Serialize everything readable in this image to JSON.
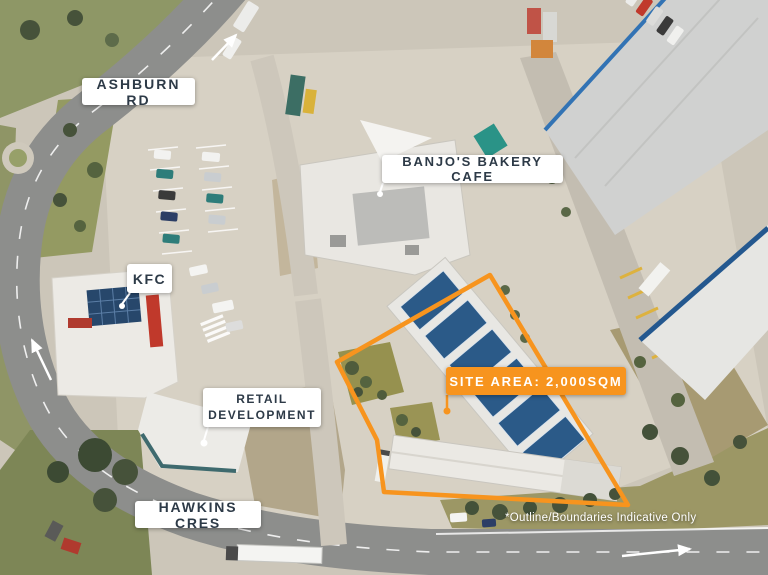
{
  "colors": {
    "accent_orange": "#F7941E",
    "label_background": "#FFFFFF",
    "label_text": "#2D3A47",
    "disclaimer_text": "#FFFFFF"
  },
  "labels": {
    "ashburn_rd": "ASHBURN RD",
    "banjos_bakery_cafe": "BANJO'S BAKERY CAFE",
    "kfc": "KFC",
    "retail_development": "RETAIL DEVELOPMENT",
    "site_area": "SITE AREA: 2,000SQM",
    "hawkins_cres": "HAWKINS CRES",
    "disclaimer": "*Outline/Boundaries Indicative Only"
  },
  "site": {
    "outline_points": "490,275 628,505 384,492 377,440 337,362",
    "outline_color": "#F7941E",
    "area_text": "SITE AREA: 2,000SQM"
  },
  "icons": {
    "arrows": [
      "road-direction-arrow-northeast",
      "road-direction-arrow-north",
      "road-direction-arrow-east"
    ]
  }
}
